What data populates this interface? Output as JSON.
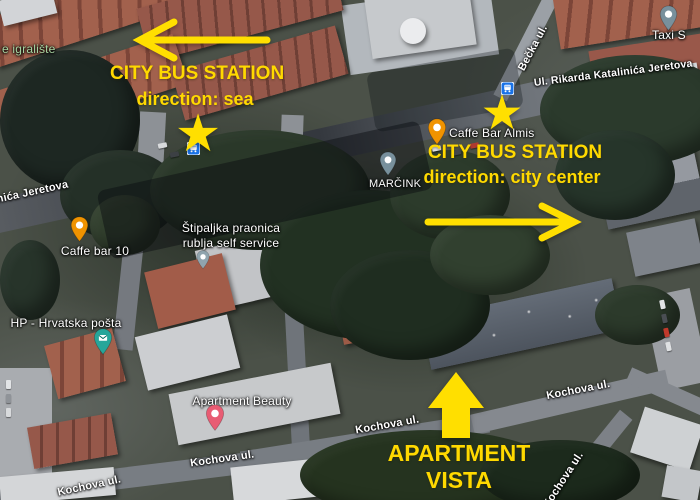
{
  "annotations": {
    "bus_sea": {
      "title": "CITY BUS STATION",
      "direction": "direction: sea"
    },
    "bus_center": {
      "title": "CITY BUS STATION",
      "direction": "direction: city center"
    },
    "apartment": {
      "line1": "APARTMENT",
      "line2": "VISTA"
    },
    "star_glyph": "★"
  },
  "streets": {
    "jeretova_cut": "nića Jeretova",
    "rikarda": "Ul. Rikarda Katalinića Jeretova",
    "becka": "Bečka ul.",
    "kochova": [
      "Kochova ul.",
      "Kochova ul.",
      "Kochova ul.",
      "Kochova ul.",
      "Kochova ul."
    ]
  },
  "pois": {
    "igraliste": "e igralište",
    "caffe10": "Caffe bar 10",
    "stipaljka_line1": "Štipaljka praonica",
    "stipaljka_line2": "rublja self service",
    "posta": "HP - Hrvatska pošta",
    "almis": "Caffe Bar Almis",
    "marcink": "MARČINK",
    "beauty": "Apartment Beauty",
    "taxi": "Taxi S"
  },
  "colors": {
    "annotation_yellow": "#ffdf00",
    "annotation_text_yellow": "#ffd900",
    "bus_icon_blue": "#1a73e8",
    "cafe_pin_orange": "#f09300",
    "post_pin_teal": "#26a69a",
    "lodging_pin_pink": "#e85c73",
    "generic_pin_gray": "#78909c",
    "park_label_green": "#a8d5a2"
  }
}
